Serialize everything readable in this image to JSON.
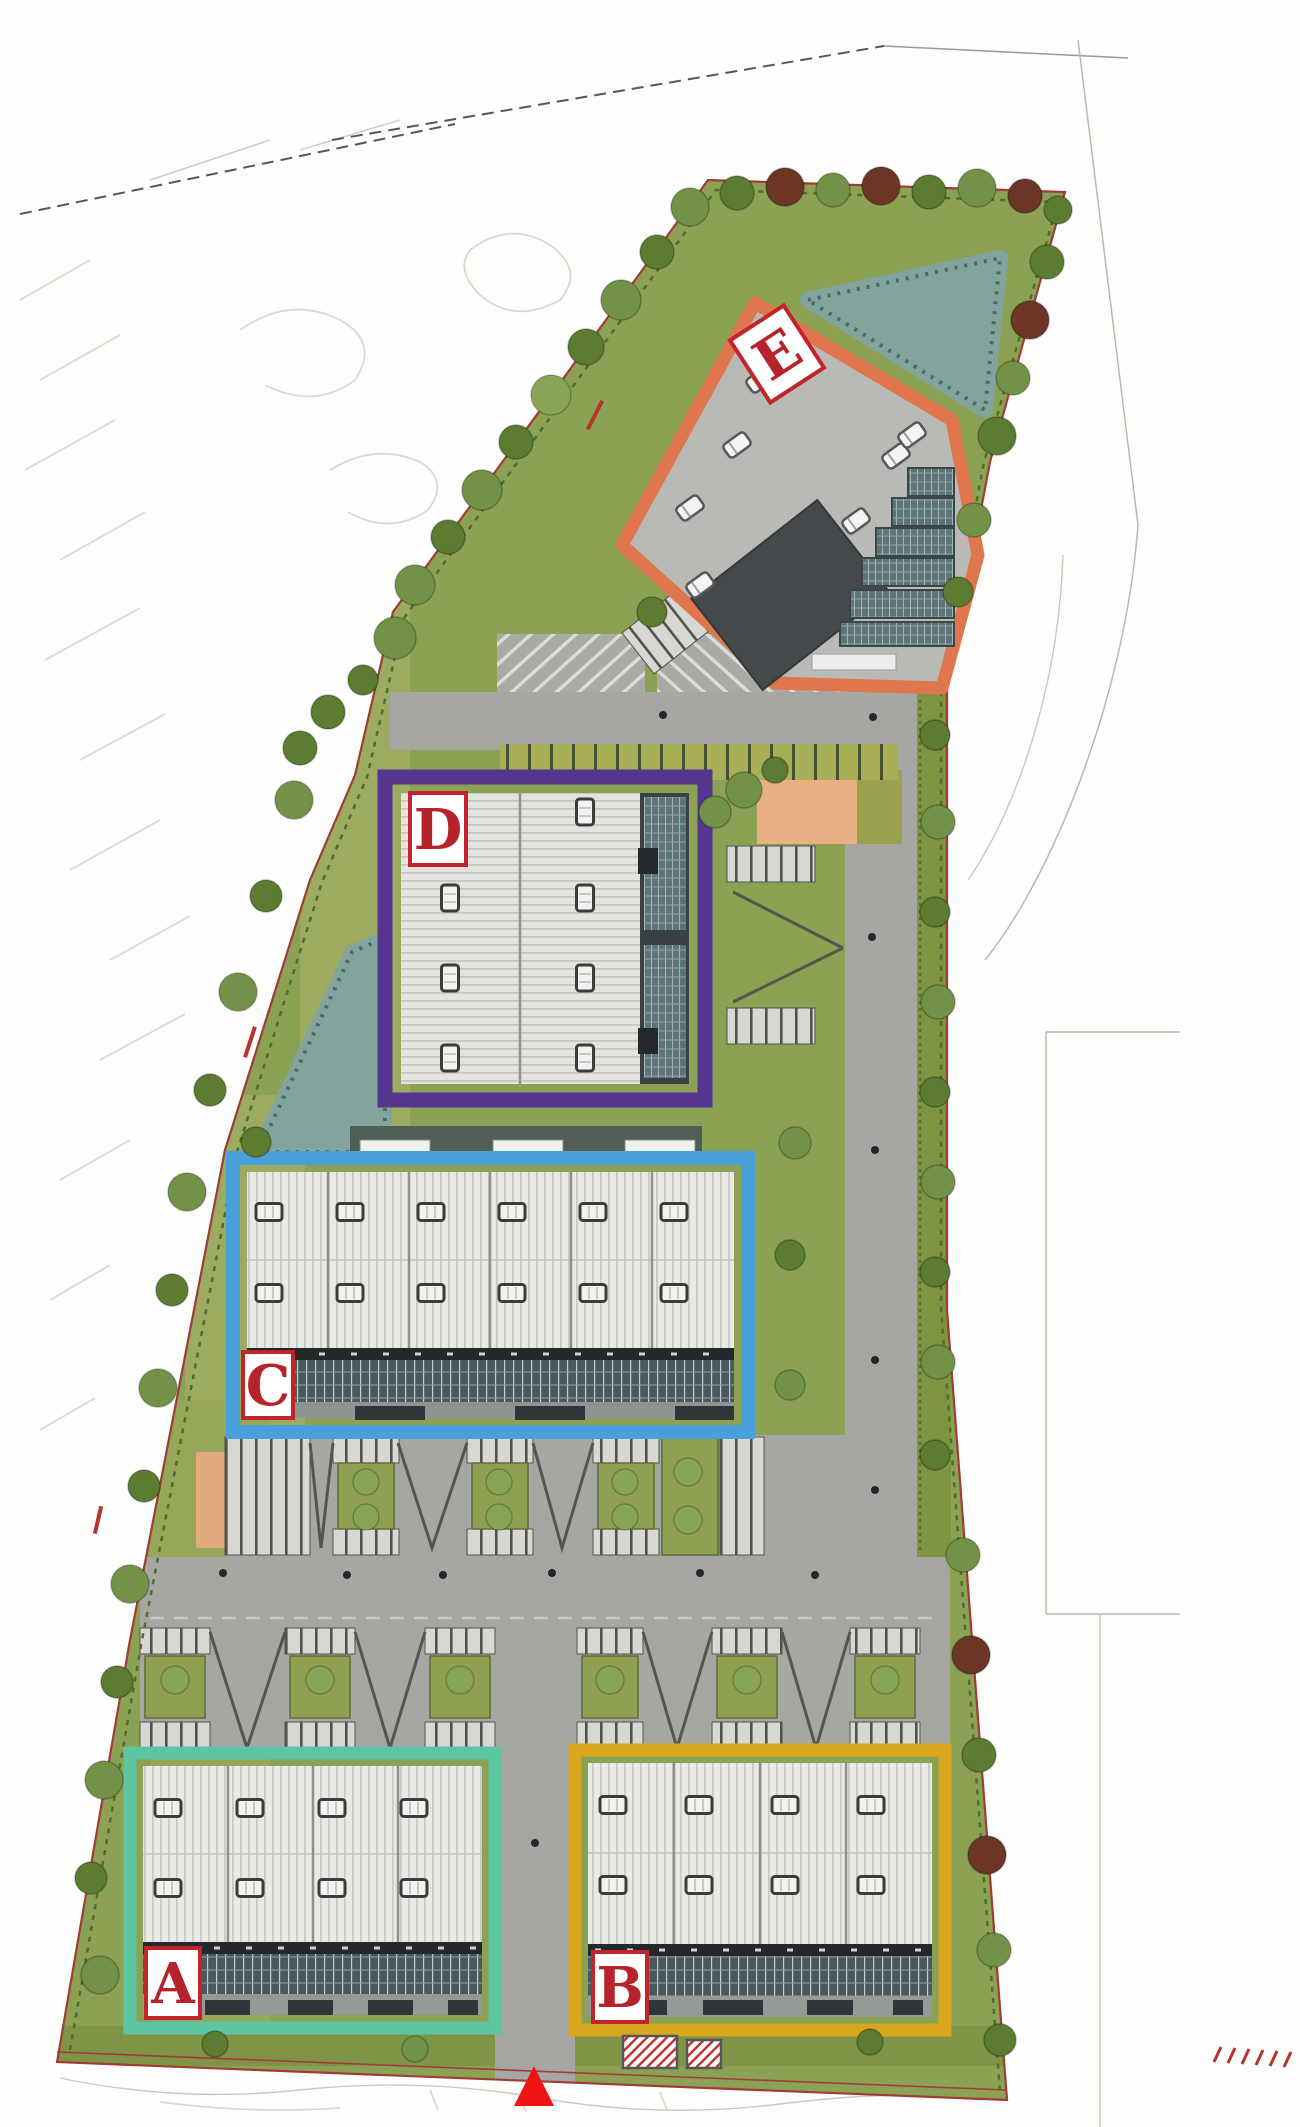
{
  "plots": {
    "A": {
      "label": "A",
      "border_color": "#5cc6a2"
    },
    "B": {
      "label": "B",
      "border_color": "#d9a81f"
    },
    "C": {
      "label": "C",
      "border_color": "#4aa0d8"
    },
    "D": {
      "label": "D",
      "border_color": "#55368f"
    },
    "E": {
      "label": "E",
      "border_color": "#e0764e"
    }
  },
  "labels": {
    "box_fill": "#ffffff",
    "box_border": "#c2242c",
    "letter_color": "#b6232a"
  },
  "markers": {
    "site_entrance_color": "#ee1512"
  },
  "palette": {
    "site_green": "#8ba153",
    "road": "#a6a6a3",
    "plot_e_paving": "#b9bab6",
    "roof": "#e9eae6",
    "facade": "#49565b",
    "pond": "#83a49d",
    "plaza": "#e9b183"
  }
}
